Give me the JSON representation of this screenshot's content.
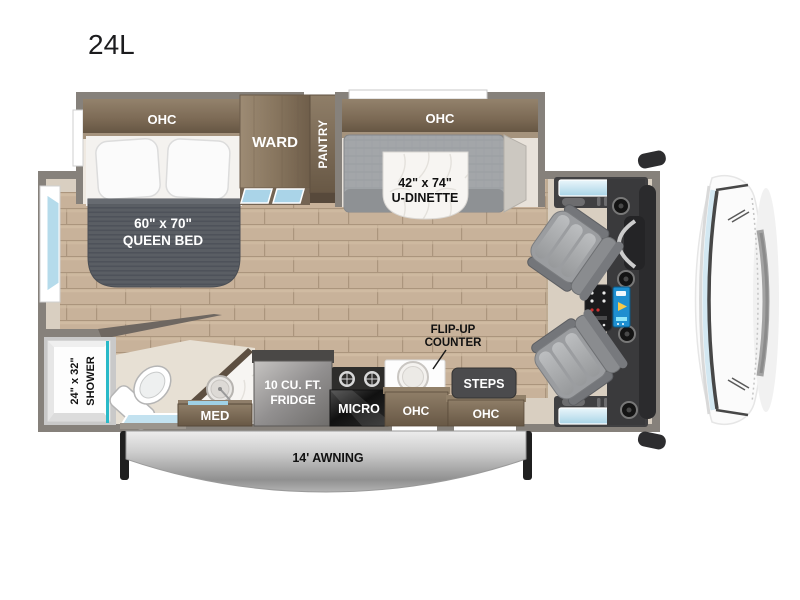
{
  "title": "24L",
  "labels": {
    "ohc_bed": "OHC",
    "ward": "WARD",
    "pantry": "PANTRY",
    "ohc_dinette": "OHC",
    "dinette_size": "42\" x 74\"",
    "dinette_name": "U-DINETTE",
    "bed_size": "60\" x 70\"",
    "bed_name": "QUEEN BED",
    "shower_size": "24\" x 32\"",
    "shower_name": "SHOWER",
    "med": "MED",
    "fridge_line1": "10 CU. FT.",
    "fridge_line2": "FRIDGE",
    "micro": "MICRO",
    "flip_up_line1": "FLIP-UP",
    "flip_up_line2": "COUNTER",
    "ohc_kitchen": "OHC",
    "steps": "STEPS",
    "ohc_entry": "OHC",
    "awning": "14' AWNING"
  },
  "colors": {
    "wall": "#86817b",
    "cabinet_dark": "#6a5a47",
    "cabinet_light": "#93826c",
    "wood_floor": "#c8b29a",
    "beige_floor": "#d9cfc1",
    "glass_blue": "#b5dbeb",
    "shower_glass_teal": "#29b9c8",
    "mattress_gray": "#5a5e64",
    "dinette_gray": "#a3a6a9",
    "awning_gray": "#b3b3b3",
    "cab_dark": "#3a3a3c",
    "marble_white": "#f7f5f2"
  }
}
